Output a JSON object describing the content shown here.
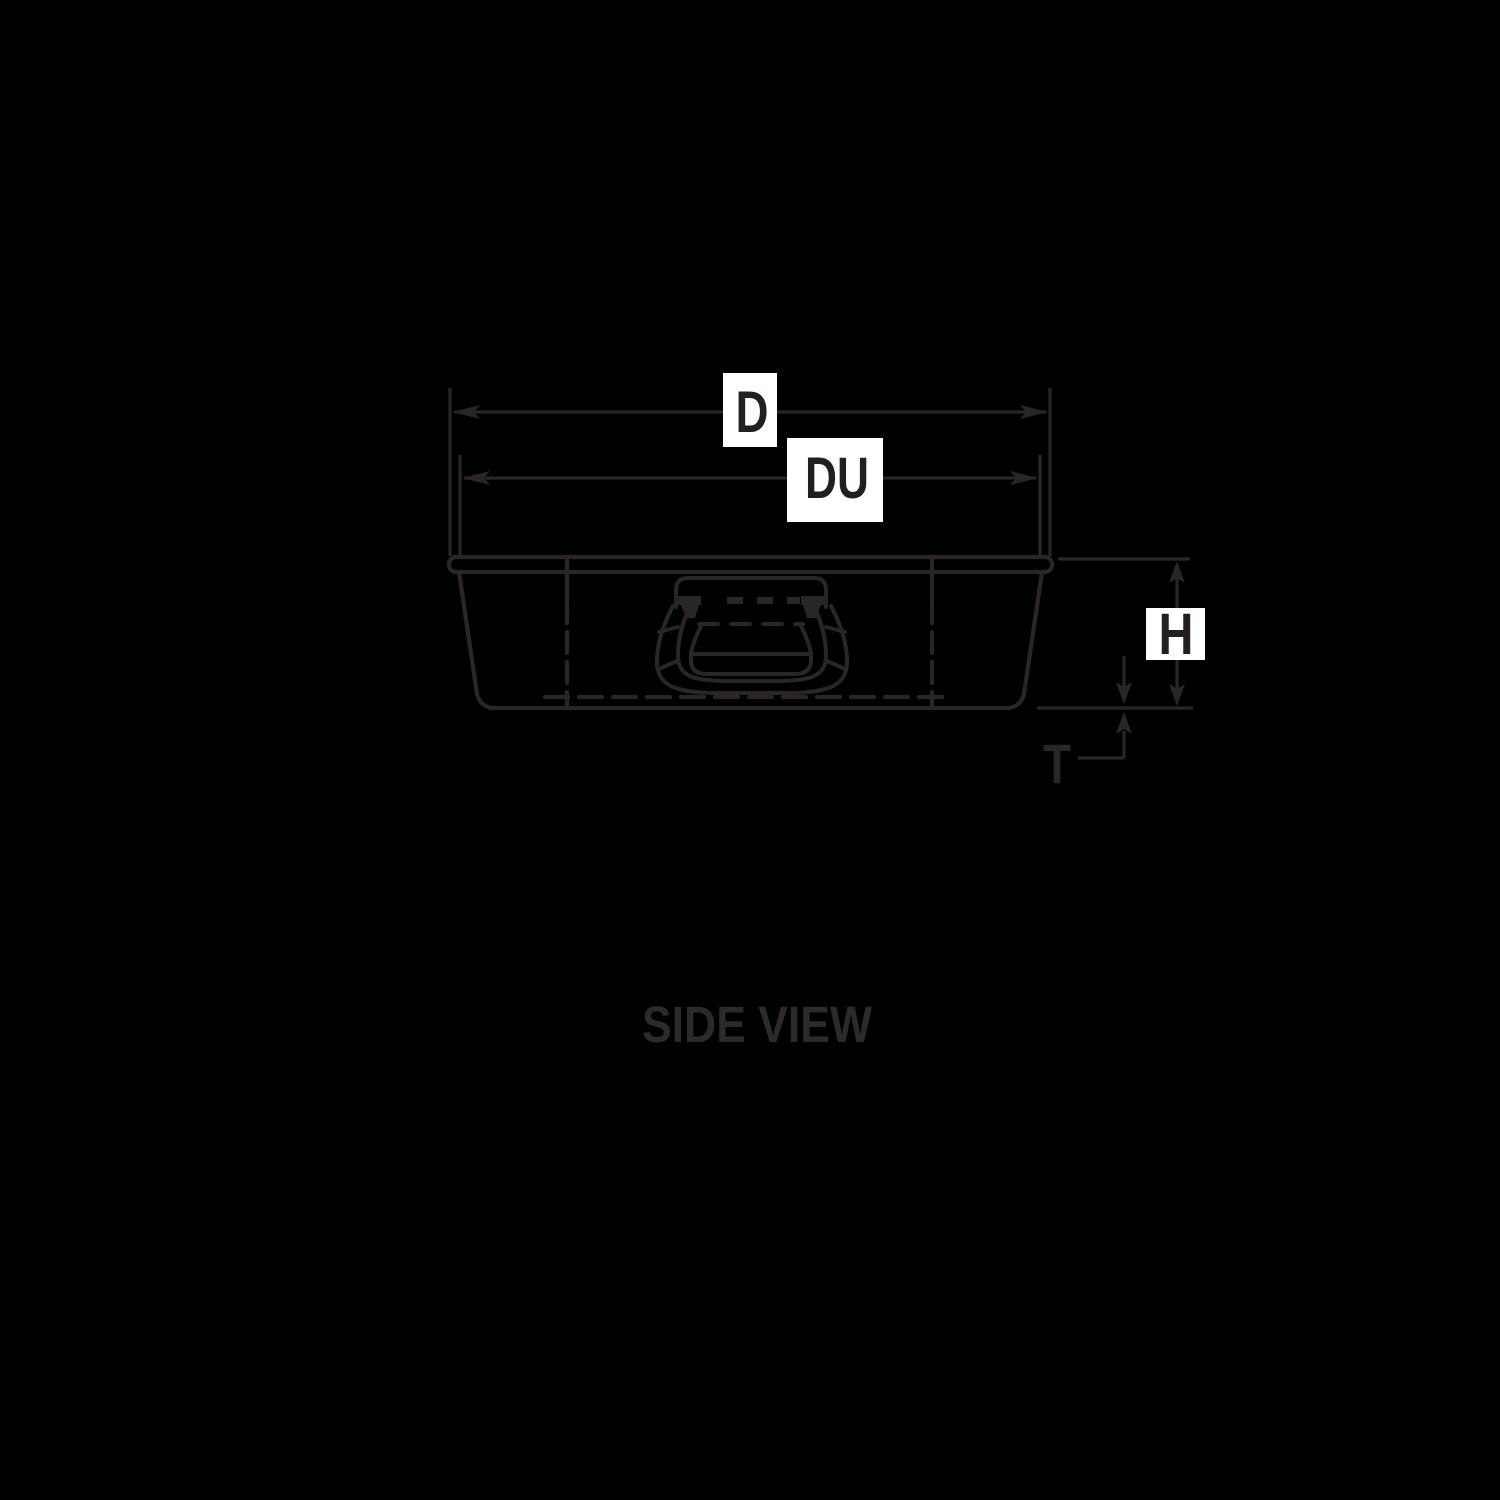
{
  "caption": {
    "text": "SIDE VIEW"
  },
  "dimension_labels": {
    "d": "D",
    "du": "DU",
    "h": "H",
    "t": "T"
  },
  "colors": {
    "background": "#000000",
    "line": "#2a2526",
    "label_bg": "#ffffff",
    "label_text": "#231f20",
    "caption_text": "#2e2a2b"
  }
}
